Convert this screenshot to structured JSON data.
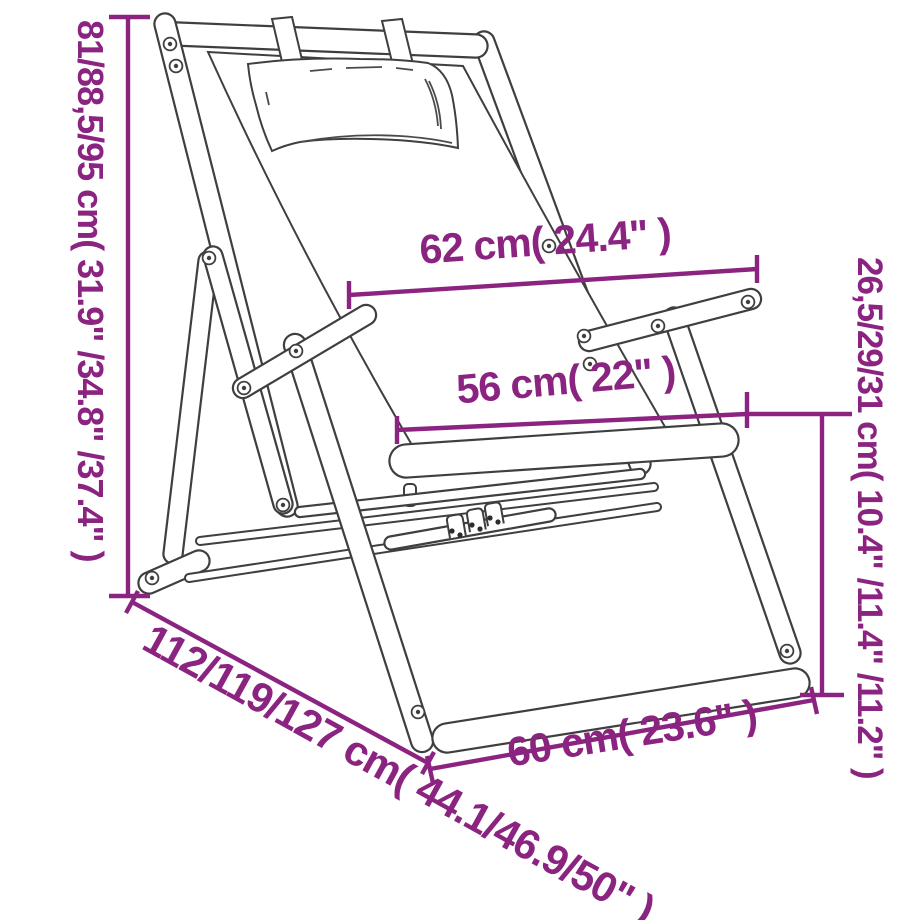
{
  "page": {
    "background": "#ffffff"
  },
  "diagram": {
    "kind": "furniture-dimension-line-drawing",
    "subject": "folding wooden deck chair with headrest pillow and armrests",
    "accent_color": "#8b2381",
    "line_color": "#3f3f3f",
    "labels": {
      "height": "81/88,5/95 cm( 31.9\" /34.8\" /37.4\" )",
      "back_width": "62 cm( 24.4\" )",
      "seat_width": "56 cm( 22\" )",
      "seat_front_height": "26,5/29/31 cm( 10.4\" /11.4\" /11.2\" )",
      "total_depth": "112/119/127 cm( 44.1/46.9/50\" )",
      "base_front_width": "60 cm( 23.6\" )"
    }
  }
}
